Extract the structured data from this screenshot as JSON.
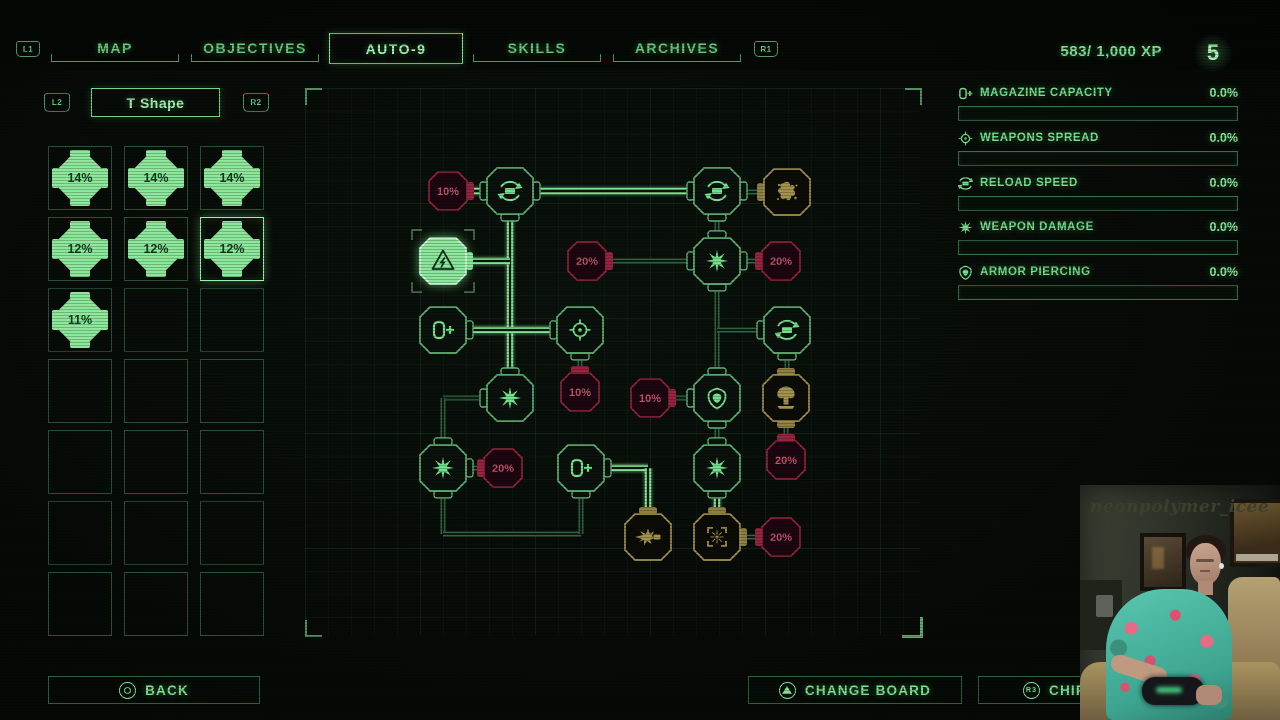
{
  "top_nav": {
    "l1": "L1",
    "r1": "R1",
    "tabs": [
      {
        "label": "MAP",
        "selected": false
      },
      {
        "label": "OBJECTIVES",
        "selected": false
      },
      {
        "label": "AUTO-9",
        "selected": true
      },
      {
        "label": "SKILLS",
        "selected": false
      },
      {
        "label": "ARCHIVES",
        "selected": false
      }
    ],
    "xp": "583/ 1,000 XP",
    "level": "5"
  },
  "board_selector": {
    "l2": "L2",
    "title": "T Shape",
    "r2": "R2"
  },
  "chip_grid": {
    "cols": 3,
    "rows": 7,
    "cells": [
      "14%",
      "14%",
      "14%",
      "12%",
      "12%",
      "12%",
      "11%",
      "",
      "",
      "",
      "",
      "",
      "",
      "",
      "",
      "",
      "",
      "",
      "",
      "",
      ""
    ],
    "selected_index": 5
  },
  "stats": {
    "items": [
      {
        "icon": "magazine-icon",
        "label": "MAGAZINE CAPACITY",
        "value": "0.0%",
        "fill": 0
      },
      {
        "icon": "crosshair-icon",
        "label": "WEAPONS SPREAD",
        "value": "0.0%",
        "fill": 0
      },
      {
        "icon": "reload-icon",
        "label": "RELOAD SPEED",
        "value": "0.0%",
        "fill": 0
      },
      {
        "icon": "burst-icon",
        "label": "WEAPON DAMAGE",
        "value": "0.0%",
        "fill": 0
      },
      {
        "icon": "shield-icon",
        "label": "ARMOR PIERCING",
        "value": "0.0%",
        "fill": 0
      }
    ]
  },
  "board": {
    "colors": {
      "powered": "#7fe293",
      "dim": "#2f6342",
      "line_core": "#0a130c",
      "skill_stroke": "#5fb374",
      "skill_fill": "#0b110c",
      "skill_icon": "#74e08c",
      "malus_stroke": "#992441",
      "malus_fill": "#1c0610",
      "malus_text": "#c2526b",
      "gold": "#a3924c",
      "gold_fill": "#0c0c07",
      "gold_tab": "#8f7f42",
      "power_fill": "#8ce79c",
      "power_stroke": "#d2f8da",
      "power_icon": "#0d3019"
    },
    "edges": [
      {
        "x1": 487,
        "y1": 398,
        "x2": 443,
        "y2": 398,
        "state": "dim"
      },
      {
        "x1": 443,
        "y1": 398,
        "x2": 443,
        "y2": 446,
        "state": "dim"
      },
      {
        "x1": 443,
        "y1": 490,
        "x2": 443,
        "y2": 534,
        "state": "dim"
      },
      {
        "x1": 443,
        "y1": 534,
        "x2": 581,
        "y2": 534,
        "state": "dim"
      },
      {
        "x1": 581,
        "y1": 534,
        "x2": 581,
        "y2": 490,
        "state": "dim"
      },
      {
        "x1": 717,
        "y1": 214,
        "x2": 717,
        "y2": 239,
        "state": "dim"
      },
      {
        "x1": 717,
        "y1": 284,
        "x2": 717,
        "y2": 376,
        "state": "dim"
      },
      {
        "x1": 717,
        "y1": 330,
        "x2": 764,
        "y2": 330,
        "state": "dim"
      },
      {
        "x1": 787,
        "y1": 353,
        "x2": 787,
        "y2": 376,
        "state": "dim"
      },
      {
        "x1": 610,
        "y1": 261,
        "x2": 694,
        "y2": 261,
        "state": "dim"
      },
      {
        "x1": 739,
        "y1": 261,
        "x2": 760,
        "y2": 261,
        "state": "dim"
      },
      {
        "x1": 580,
        "y1": 353,
        "x2": 580,
        "y2": 372,
        "state": "dim"
      },
      {
        "x1": 673,
        "y1": 398,
        "x2": 694,
        "y2": 398,
        "state": "dim"
      },
      {
        "x1": 466,
        "y1": 468,
        "x2": 484,
        "y2": 468,
        "state": "dim"
      },
      {
        "x1": 739,
        "y1": 192,
        "x2": 763,
        "y2": 192,
        "state": "dim"
      },
      {
        "x1": 717,
        "y1": 421,
        "x2": 717,
        "y2": 446,
        "state": "dim"
      },
      {
        "x1": 786,
        "y1": 421,
        "x2": 786,
        "y2": 440,
        "state": "dim"
      },
      {
        "x1": 739,
        "y1": 537,
        "x2": 760,
        "y2": 537,
        "state": "dim"
      },
      {
        "x1": 510,
        "y1": 213,
        "x2": 510,
        "y2": 376,
        "state": "powered"
      },
      {
        "x1": 466,
        "y1": 261,
        "x2": 510,
        "y2": 261,
        "state": "powered"
      },
      {
        "x1": 466,
        "y1": 330,
        "x2": 558,
        "y2": 330,
        "state": "powered"
      },
      {
        "x1": 533,
        "y1": 191,
        "x2": 694,
        "y2": 191,
        "state": "powered"
      },
      {
        "x1": 464,
        "y1": 191,
        "x2": 488,
        "y2": 191,
        "state": "powered"
      },
      {
        "x1": 604,
        "y1": 468,
        "x2": 648,
        "y2": 468,
        "state": "powered"
      },
      {
        "x1": 648,
        "y1": 468,
        "x2": 648,
        "y2": 514,
        "state": "powered"
      },
      {
        "x1": 717,
        "y1": 490,
        "x2": 717,
        "y2": 514,
        "state": "powered"
      }
    ],
    "nodes": [
      {
        "id": "reload-node-a",
        "x": 510,
        "y": 191,
        "kind": "skill",
        "icon": "reload-icon",
        "tabs": [
          "left",
          "right",
          "bottom"
        ]
      },
      {
        "id": "power-core-node",
        "x": 443,
        "y": 261,
        "kind": "power",
        "icon": "power-surge-icon",
        "tabs": [
          "right"
        ]
      },
      {
        "id": "magazine-node-a",
        "x": 443,
        "y": 330,
        "kind": "skill",
        "icon": "magazine-icon",
        "tabs": [
          "right"
        ]
      },
      {
        "id": "spread-node-a",
        "x": 580,
        "y": 330,
        "kind": "skill",
        "icon": "crosshair-icon",
        "tabs": [
          "left",
          "bottom"
        ]
      },
      {
        "id": "damage-node-a",
        "x": 510,
        "y": 398,
        "kind": "skill",
        "icon": "burst-icon",
        "tabs": [
          "top",
          "left"
        ]
      },
      {
        "id": "damage-node-b",
        "x": 443,
        "y": 468,
        "kind": "skill",
        "icon": "burst-icon",
        "tabs": [
          "top",
          "bottom",
          "right"
        ]
      },
      {
        "id": "magazine-node-b",
        "x": 581,
        "y": 468,
        "kind": "skill",
        "icon": "magazine-icon",
        "tabs": [
          "right",
          "bottom"
        ]
      },
      {
        "id": "reload-node-b",
        "x": 717,
        "y": 191,
        "kind": "skill",
        "icon": "reload-icon",
        "tabs": [
          "left",
          "right",
          "bottom"
        ]
      },
      {
        "id": "damage-node-c",
        "x": 717,
        "y": 261,
        "kind": "skill",
        "icon": "burst-icon",
        "tabs": [
          "top",
          "left",
          "right",
          "bottom"
        ]
      },
      {
        "id": "reload-node-c",
        "x": 787,
        "y": 330,
        "kind": "skill",
        "icon": "reload-icon",
        "tabs": [
          "left",
          "bottom"
        ]
      },
      {
        "id": "armor-node",
        "x": 717,
        "y": 398,
        "kind": "skill",
        "icon": "shield-icon",
        "tabs": [
          "top",
          "left",
          "bottom"
        ]
      },
      {
        "id": "damage-node-d",
        "x": 717,
        "y": 468,
        "kind": "skill",
        "icon": "burst-icon",
        "tabs": [
          "top",
          "bottom"
        ]
      },
      {
        "id": "splat-gold-node",
        "x": 787,
        "y": 192,
        "kind": "gold",
        "icon": "splat-icon",
        "tabs": [
          "left"
        ]
      },
      {
        "id": "nuke-gold-node",
        "x": 786,
        "y": 398,
        "kind": "gold",
        "icon": "mushroom-icon",
        "tabs": [
          "top",
          "bottom"
        ]
      },
      {
        "id": "muzzle-gold-node",
        "x": 648,
        "y": 537,
        "kind": "gold",
        "icon": "muzzle-flash-icon",
        "tabs": [
          "top"
        ]
      },
      {
        "id": "reticle-gold-node",
        "x": 717,
        "y": 537,
        "kind": "gold",
        "icon": "reticle-icon",
        "tabs": [
          "top",
          "right"
        ]
      },
      {
        "id": "malus-node-1",
        "x": 448,
        "y": 191,
        "kind": "malus",
        "label": "10%",
        "tabs": [
          "right"
        ]
      },
      {
        "id": "malus-node-2",
        "x": 587,
        "y": 261,
        "kind": "malus",
        "label": "20%",
        "tabs": [
          "right"
        ]
      },
      {
        "id": "malus-node-3",
        "x": 781,
        "y": 261,
        "kind": "malus",
        "label": "20%",
        "tabs": [
          "left"
        ]
      },
      {
        "id": "malus-node-4",
        "x": 580,
        "y": 392,
        "kind": "malus",
        "label": "10%",
        "tabs": [
          "top"
        ]
      },
      {
        "id": "malus-node-5",
        "x": 650,
        "y": 398,
        "kind": "malus",
        "label": "10%",
        "tabs": [
          "right"
        ]
      },
      {
        "id": "malus-node-6",
        "x": 503,
        "y": 468,
        "kind": "malus",
        "label": "20%",
        "tabs": [
          "left"
        ]
      },
      {
        "id": "malus-node-7",
        "x": 786,
        "y": 460,
        "kind": "malus",
        "label": "20%",
        "tabs": [
          "top"
        ]
      },
      {
        "id": "malus-node-8",
        "x": 781,
        "y": 537,
        "kind": "malus",
        "label": "20%",
        "tabs": [
          "left"
        ]
      }
    ]
  },
  "footer": {
    "back_label": "BACK",
    "change_board_label": "CHANGE BOARD",
    "chip_label": "CHIP M",
    "r3_label": "R3"
  },
  "webcam": {
    "watermark": "neonpolymer_icee"
  }
}
